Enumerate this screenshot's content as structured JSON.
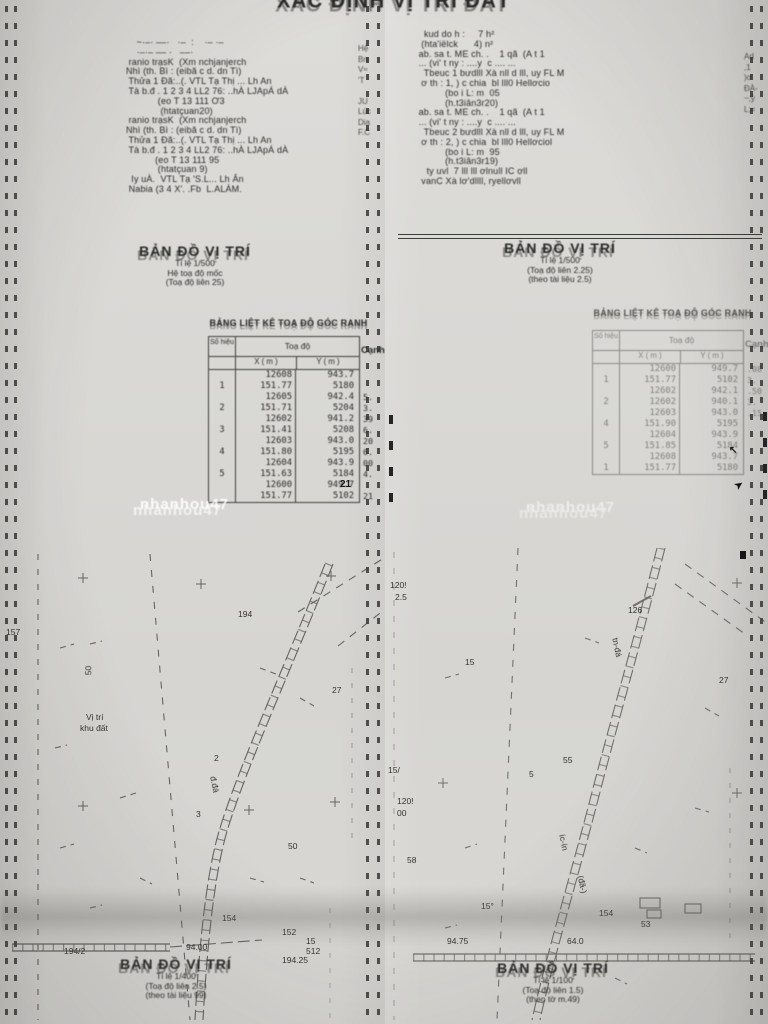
{
  "document": {
    "title": "XÁC ĐỊNH VỊ TRÍ ĐẤT",
    "watermark": "nhanhou47"
  },
  "left_page": {
    "info_lines": [
      "    ~·–· ––·   ·–  :    ·– ·–",
      "    ·–·– –– ·   ––·",
      " ranio trạsK  (Xm nchjanjerch",
      "Nhì (th. Bì : (eibă c d. dn Tì)",
      " Thửa 1 Đã:..(. VTL Tạ Thị ... Lh An",
      " Tà b.đ . 1 2 3 4 LL2 76: ..hÀ LJApÁ dÀ",
      "",
      "            (eo T 13 111 Ơ3",
      "             (htatçuan20)",
      " ranio trạsK  (Xm nchjanjerch",
      "Nhì (th. Bì : (eibă c d. dn Tì)",
      " Thửa 1 Đã:..(. VTL Tạ Thị ... Lh An",
      " Tà b.đ . 1 2 3 4 LL2 76: ..hÀ LJApÁ dÀ",
      "",
      "           (eo T 13 111 95",
      "            (htatçuan 9)",
      "  Iy uÀ.  VTL Tạ 'S.L... Lh Ân",
      " Nabia (3 4 X'. .Fb  L.ALÀM."
    ],
    "margin_col": "Hệ\nBn\nV≈\n'T\n\nJU\nLúc\nDia\nF.C",
    "map_header": {
      "title": "BẢN ĐỒ VỊ TRÍ",
      "lines": [
        "Tỉ lệ 1/500",
        "Hệ toạ độ mốc",
        "(Toạ độ liên 25)"
      ]
    },
    "table_title": "BẢNG LIỆT KÊ TOẠ ĐỘ GÓC RANH",
    "table": {
      "col_num": "Số hiệu",
      "col_group": "Toạ độ",
      "col_x": "X ( m )",
      "col_y": "Y ( m )",
      "col_edge": "Cạnh",
      "rows": [
        [
          "",
          "12608",
          "943.7",
          ""
        ],
        [
          "1",
          "151.77",
          "5180",
          ""
        ],
        [
          "",
          "12605",
          "942.4",
          "5."
        ],
        [
          "2",
          "151.71",
          "5204",
          "3."
        ],
        [
          "",
          "12602",
          "941.2",
          "39"
        ],
        [
          "3",
          "151.41",
          "5208",
          "6."
        ],
        [
          "",
          "12603",
          "943.0",
          "20"
        ],
        [
          "4",
          "151.80",
          "5195",
          "6."
        ],
        [
          "",
          "12604",
          "943.9",
          "00"
        ],
        [
          "5",
          "151.63",
          "5184",
          "4."
        ],
        [
          "",
          "12600",
          "949.7",
          ""
        ],
        [
          "",
          "151.77",
          "5102",
          "21"
        ]
      ]
    },
    "map_labels": [
      {
        "t": "194",
        "x": 238,
        "y": 62
      },
      {
        "t": "157",
        "x": 6,
        "y": 80
      },
      {
        "t": "50",
        "x": 84,
        "y": 118,
        "r": -90
      },
      {
        "t": "27",
        "x": 332,
        "y": 138
      },
      {
        "t": "Vị trí",
        "x": 86,
        "y": 165
      },
      {
        "t": "khu đất",
        "x": 80,
        "y": 176
      },
      {
        "t": "2",
        "x": 214,
        "y": 206
      },
      {
        "t": "đ.đá",
        "x": 206,
        "y": 232,
        "r": 78
      },
      {
        "t": "3",
        "x": 196,
        "y": 262
      },
      {
        "t": "50",
        "x": 288,
        "y": 294
      },
      {
        "t": "154",
        "x": 222,
        "y": 366
      },
      {
        "t": "152",
        "x": 282,
        "y": 380
      },
      {
        "t": "15",
        "x": 306,
        "y": 389
      },
      {
        "t": "512",
        "x": 306,
        "y": 399
      },
      {
        "t": "194.25",
        "x": 282,
        "y": 408
      },
      {
        "t": "94.00",
        "x": 186,
        "y": 395
      },
      {
        "t": "194/2",
        "x": 64,
        "y": 399
      }
    ],
    "stray_marks": [
      {
        "t": "21",
        "x": 340,
        "y": 480,
        "b": true
      }
    ],
    "bottom_header": {
      "title": "BẢN ĐỒ VỊ TRÍ",
      "lines": [
        "Tỉ lệ 1/400",
        "(Toạ độ liên 2.5)",
        "(theo tài liệu 99)"
      ]
    }
  },
  "right_page": {
    "info_lines": [
      "   kud do h :     7 h²",
      "  (hta'iëlck      4) n²",
      " ab. sa t. ME ch. .    1 qã  (A t 1",
      " ... (vi' t ny : ....y  c .... ...",
      "   Tbeuc 1 bưdlll Xà nll d lll, uy FL M",
      "  ơ th : 1, ) c chia  bl lll0 Hellơcio",
      "           (bo i L: m  05",
      "           (h.t3iân3r20)",
      " ab. sa t. ME ch. .    1 qã  (A t 1",
      " ... (vi' t ny : ....y  c .... ...",
      "   Tbeuc 2 bưdlll Xà nll d lll, uy FL M",
      "  ơ th : 2, ) c chia  bl lll0 Hellơciol",
      "           (bo i L: m  95",
      "           (h.t3iân3r19)",
      "",
      "    ty uvl  7 lll lll ơlnull IC ơll",
      "  vanC Xà lơ'dllll, ryellơvll"
    ],
    "margin_col": "Ad\n,1\n)ơ\nĐÀ-\n~;ý\nL;=",
    "map_header": {
      "title": "BẢN ĐỒ VỊ TRÍ",
      "lines": [
        "Tỉ lệ 1/500",
        "(Toạ độ liên 2.25)",
        "(theo tài liệu 2.5)"
      ]
    },
    "table_title": "BẢNG LIỆT KÊ TOẠ ĐỘ GÓC RANH",
    "table": {
      "col_num": "Số hiệu",
      "col_group": "Toạ độ",
      "col_x": "X ( m )",
      "col_y": "Y ( m )",
      "col_edge": "Cạnh",
      "rows": [
        [
          "",
          "12600",
          "949.7",
          ".08"
        ],
        [
          "1",
          "151.77",
          "5102",
          "3."
        ],
        [
          "",
          "12602",
          "942.1",
          ".50"
        ],
        [
          "2",
          "12602",
          "940.1",
          "3."
        ],
        [
          "",
          "12603",
          "943.0",
          ".15"
        ],
        [
          "4",
          "151.90",
          "5195",
          ""
        ],
        [
          "",
          "12604",
          "943.9",
          ""
        ],
        [
          "5",
          "151.85",
          "5184",
          ""
        ],
        [
          "",
          "12608",
          "943.7",
          ""
        ],
        [
          "1",
          "151.77",
          "5180",
          ""
        ]
      ]
    },
    "map_labels": [
      {
        "t": "120!",
        "x": 5,
        "y": 33
      },
      {
        "t": "2.5",
        "x": 10,
        "y": 45
      },
      {
        "t": "126",
        "x": 243,
        "y": 58
      },
      {
        "t": "15",
        "x": 80,
        "y": 110
      },
      {
        "t": "27",
        "x": 334,
        "y": 128
      },
      {
        "t": "15/",
        "x": 3,
        "y": 218
      },
      {
        "t": "tn-đá",
        "x": 222,
        "y": 95,
        "r": 78
      },
      {
        "t": "55",
        "x": 178,
        "y": 208
      },
      {
        "t": "5",
        "x": 144,
        "y": 222
      },
      {
        "t": "120!",
        "x": 12,
        "y": 249
      },
      {
        "t": "00",
        "x": 12,
        "y": 261
      },
      {
        "t": "58",
        "x": 22,
        "y": 308
      },
      {
        "t": "íc-ín",
        "x": 170,
        "y": 290,
        "r": 78
      },
      {
        "t": "(đã-)",
        "x": 188,
        "y": 332,
        "r": 78
      },
      {
        "t": "15°",
        "x": 96,
        "y": 354
      },
      {
        "t": "154",
        "x": 214,
        "y": 361
      },
      {
        "t": "53",
        "x": 256,
        "y": 372
      },
      {
        "t": "94.75",
        "x": 62,
        "y": 389
      },
      {
        "t": "64.0",
        "x": 182,
        "y": 389
      }
    ],
    "stray_marks": [
      {
        "t": "↖",
        "x": 729,
        "y": 446,
        "b": true
      },
      {
        "t": "➤",
        "x": 735,
        "y": 481,
        "r": -35,
        "b": true
      }
    ],
    "bottom_header": {
      "title": "BẢN ĐỒ VỊ TRÍ",
      "lines": [
        "Tỉ lệ 1/100",
        "(Toạ độ liên 1.5)",
        "(theo tờ m.49)"
      ]
    }
  }
}
